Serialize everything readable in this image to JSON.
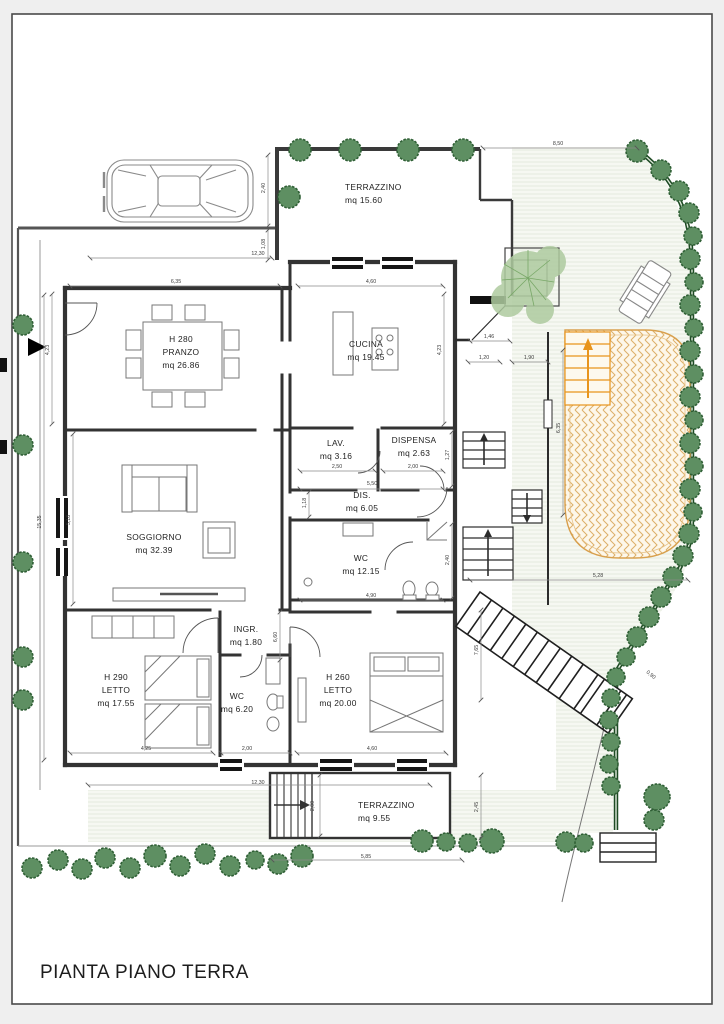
{
  "title": "PIANTA PIANO TERRA",
  "colors": {
    "tree": "#5e8f62",
    "tree_stroke": "#2f5f35",
    "hedge": "#2c5e33",
    "foliage": "#aecb9f",
    "paving_fill": "#fdf7ea",
    "paving_stroke": "#d9a95f",
    "arrow_orange": "#e8941c",
    "wall": "#3a3a3a",
    "dim": "#555555",
    "garden_bg": "#f6f8f2",
    "garden_line": "#e4eadd"
  },
  "rooms": [
    {
      "id": "terrazzino-nord",
      "lines": [
        "TERRAZZINO",
        "mq 15.60"
      ],
      "x": 345,
      "y": 190,
      "anchor": "start"
    },
    {
      "id": "pranzo",
      "lines": [
        "H 280",
        "PRANZO",
        "mq 26.86"
      ],
      "x": 181,
      "y": 342,
      "anchor": "middle"
    },
    {
      "id": "cucina",
      "lines": [
        "CUCINA",
        "mq 19.45"
      ],
      "x": 366,
      "y": 347,
      "anchor": "middle"
    },
    {
      "id": "lav",
      "lines": [
        "LAV.",
        "mq 3.16"
      ],
      "x": 336,
      "y": 446,
      "anchor": "middle"
    },
    {
      "id": "dispensa",
      "lines": [
        "DISPENSA",
        "mq 2.63"
      ],
      "x": 414,
      "y": 443,
      "anchor": "middle"
    },
    {
      "id": "dis",
      "lines": [
        "DIS.",
        "mq 6.05"
      ],
      "x": 362,
      "y": 498,
      "anchor": "middle"
    },
    {
      "id": "soggiorno",
      "lines": [
        "SOGGIORNO",
        "mq 32.39"
      ],
      "x": 154,
      "y": 540,
      "anchor": "middle"
    },
    {
      "id": "wc-grande",
      "lines": [
        "WC",
        "mq 12.15"
      ],
      "x": 361,
      "y": 561,
      "anchor": "middle"
    },
    {
      "id": "ingresso",
      "lines": [
        "INGR.",
        "mq 1.80"
      ],
      "x": 246,
      "y": 632,
      "anchor": "middle"
    },
    {
      "id": "letto-1",
      "lines": [
        "H 290",
        "LETTO",
        "mq 17.55"
      ],
      "x": 116,
      "y": 680,
      "anchor": "middle"
    },
    {
      "id": "wc-piccolo",
      "lines": [
        "WC",
        "mq 6.20"
      ],
      "x": 237,
      "y": 699,
      "anchor": "middle"
    },
    {
      "id": "letto-2",
      "lines": [
        "H 260",
        "LETTO",
        "mq 20.00"
      ],
      "x": 338,
      "y": 680,
      "anchor": "middle"
    },
    {
      "id": "terrazzino-sud",
      "lines": [
        "TERRAZZINO",
        "mq 9.55"
      ],
      "x": 358,
      "y": 808,
      "anchor": "start"
    }
  ],
  "dimensions": [
    {
      "v": "8,50",
      "x": 558,
      "y": 145,
      "r": 0
    },
    {
      "v": "2,40",
      "x": 265,
      "y": 188,
      "r": -90
    },
    {
      "v": "1,08",
      "x": 265,
      "y": 244,
      "r": -90
    },
    {
      "v": "12,30",
      "x": 258,
      "y": 255,
      "r": 0
    },
    {
      "v": "6,35",
      "x": 176,
      "y": 283,
      "r": 0
    },
    {
      "v": "4,60",
      "x": 371,
      "y": 283,
      "r": 0
    },
    {
      "v": "4,23",
      "x": 49,
      "y": 350,
      "r": -90
    },
    {
      "v": "4,23",
      "x": 441,
      "y": 350,
      "r": -90
    },
    {
      "v": "15,35",
      "x": 41,
      "y": 522,
      "r": -90
    },
    {
      "v": "5,18",
      "x": 70,
      "y": 520,
      "r": -90
    },
    {
      "v": "1,27",
      "x": 449,
      "y": 455,
      "r": -90
    },
    {
      "v": "1,46",
      "x": 489,
      "y": 338,
      "r": 0
    },
    {
      "v": "1,20",
      "x": 484,
      "y": 359,
      "r": 0
    },
    {
      "v": "1,90",
      "x": 529,
      "y": 359,
      "r": 0
    },
    {
      "v": "6,35",
      "x": 560,
      "y": 428,
      "r": -90
    },
    {
      "v": "2,50",
      "x": 337,
      "y": 468,
      "r": 0
    },
    {
      "v": "2,00",
      "x": 413,
      "y": 468,
      "r": 0
    },
    {
      "v": "5,50",
      "x": 372,
      "y": 485,
      "r": 0
    },
    {
      "v": "1,18",
      "x": 306,
      "y": 503,
      "r": -90
    },
    {
      "v": "4,90",
      "x": 371,
      "y": 597,
      "r": 0
    },
    {
      "v": "2,40",
      "x": 449,
      "y": 560,
      "r": -90
    },
    {
      "v": "6,60",
      "x": 277,
      "y": 637,
      "r": -90
    },
    {
      "v": "4,25",
      "x": 146,
      "y": 750,
      "r": 0
    },
    {
      "v": "2,00",
      "x": 247,
      "y": 750,
      "r": 0
    },
    {
      "v": "4,60",
      "x": 372,
      "y": 750,
      "r": 0
    },
    {
      "v": "12,30",
      "x": 258,
      "y": 784,
      "r": 0
    },
    {
      "v": "2,00",
      "x": 314,
      "y": 806,
      "r": -90
    },
    {
      "v": "5,85",
      "x": 366,
      "y": 858,
      "r": 0
    },
    {
      "v": "2,45",
      "x": 478,
      "y": 807,
      "r": -90
    },
    {
      "v": "7,65",
      "x": 478,
      "y": 650,
      "r": -90
    },
    {
      "v": "5,28",
      "x": 598,
      "y": 577,
      "r": 0
    },
    {
      "v": "0,90",
      "x": 650,
      "y": 676,
      "r": 40
    }
  ]
}
